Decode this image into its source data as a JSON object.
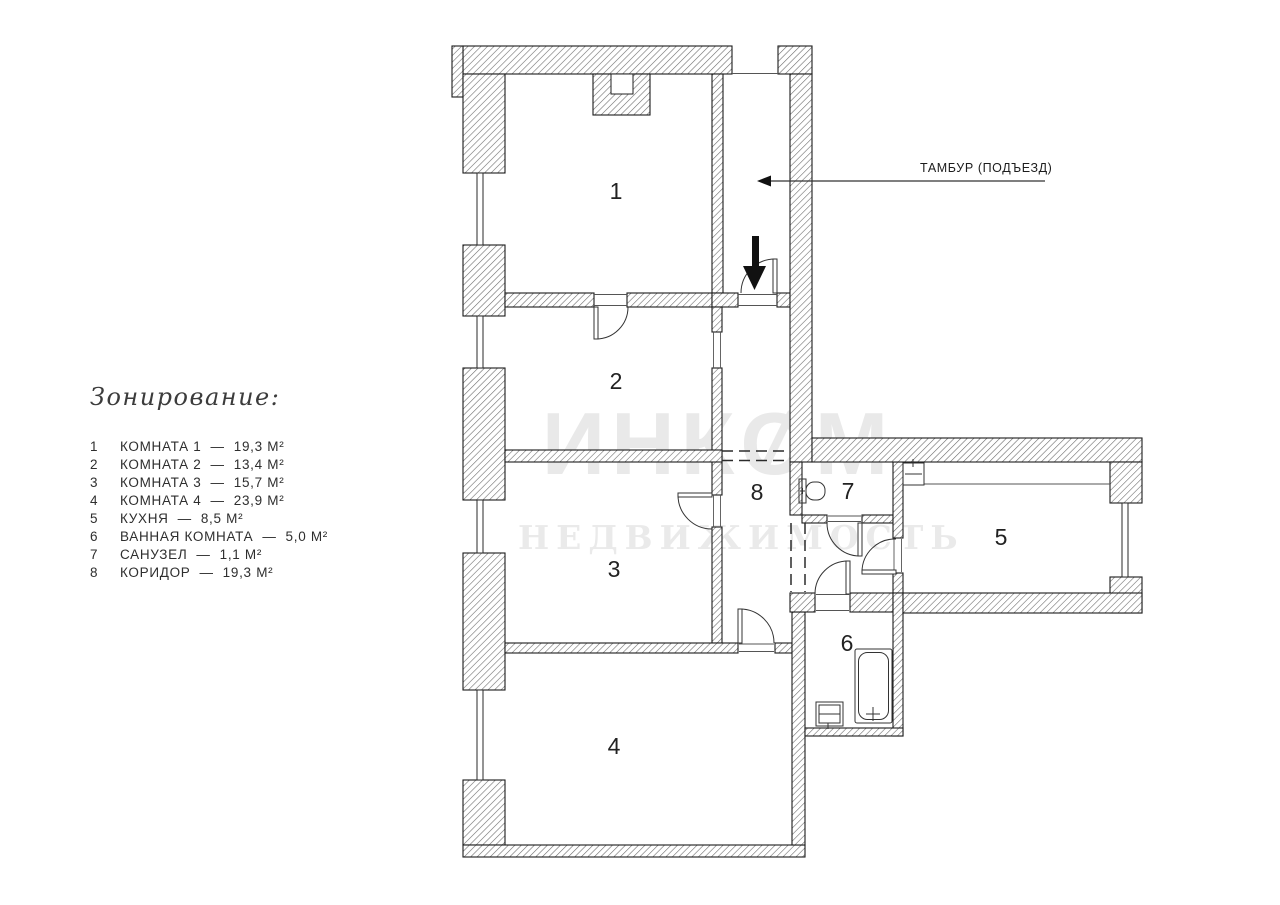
{
  "legend": {
    "title": "Зонирование:",
    "separator": "—",
    "items": [
      {
        "num": "1",
        "name": "КОМНАТА 1",
        "area": "19,3 М²"
      },
      {
        "num": "2",
        "name": "КОМНАТА 2",
        "area": "13,4 М²"
      },
      {
        "num": "3",
        "name": "КОМНАТА 3",
        "area": "15,7 М²"
      },
      {
        "num": "4",
        "name": "КОМНАТА 4",
        "area": "23,9 М²"
      },
      {
        "num": "5",
        "name": "КУХНЯ",
        "area": "8,5 М²"
      },
      {
        "num": "6",
        "name": "ВАННАЯ КОМНАТА",
        "area": "5,0 М²"
      },
      {
        "num": "7",
        "name": "САНУЗЕЛ",
        "area": "1,1 М²"
      },
      {
        "num": "8",
        "name": "КОРИДОР",
        "area": "19,3 М²"
      }
    ]
  },
  "plan": {
    "entry_label": "ТАМБУР (ПОДЪЕЗД)",
    "rooms": [
      "1",
      "2",
      "3",
      "4",
      "5",
      "6",
      "7",
      "8"
    ]
  },
  "watermark": {
    "part1": "ИНК",
    "part2": "О",
    "part3": "М",
    "line2": "НЕДВИЖИМОСТЬ"
  },
  "colors": {
    "background": "#ffffff",
    "wall_outline": "#1b1b1b",
    "hatch_line": "#6a6a6a",
    "thin_line": "#333333",
    "arrow_fill": "#111111",
    "label_text": "#222222",
    "watermark": "#e9e9e9"
  }
}
